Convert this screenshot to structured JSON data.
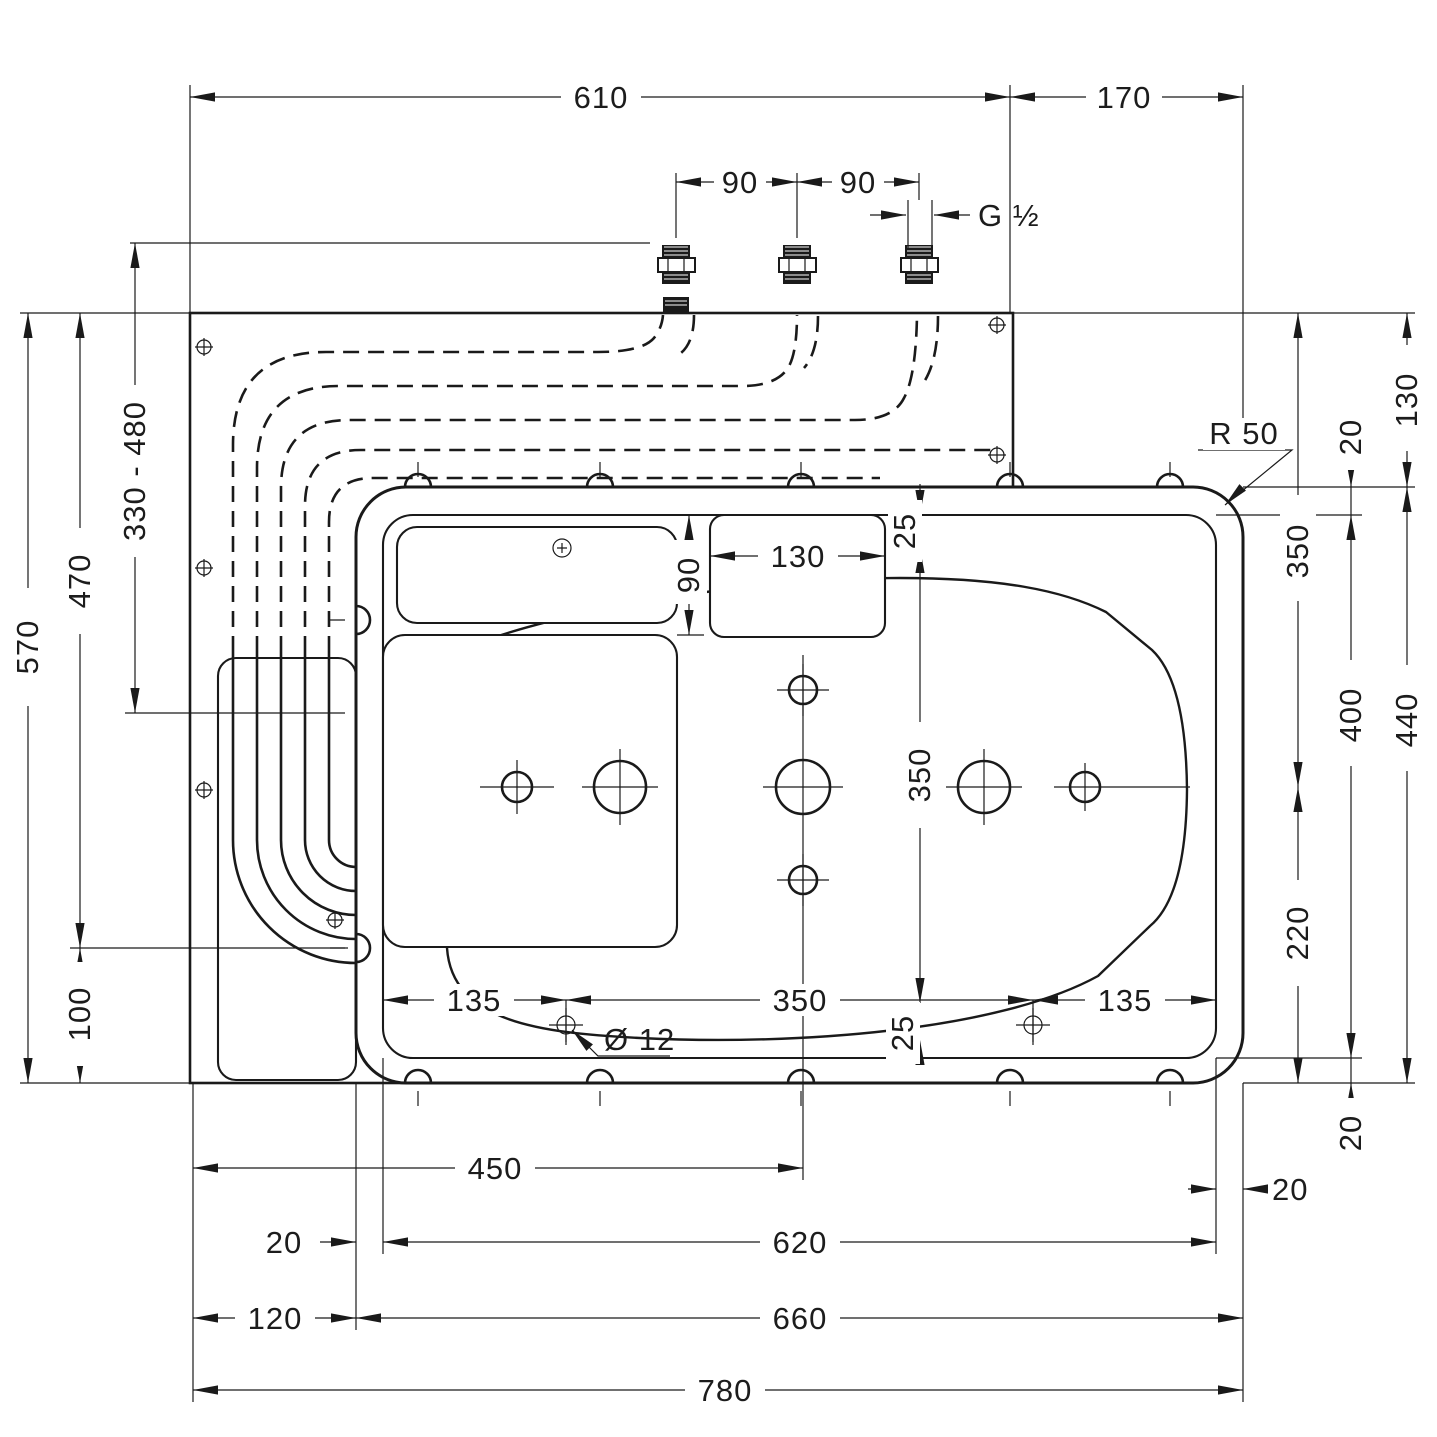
{
  "drawing": {
    "labels": {
      "t610": "610",
      "t170": "170",
      "t90a": "90",
      "t90b": "90",
      "thread": "G ½",
      "range": "330 - 480",
      "l470": "470",
      "l570": "570",
      "l100": "100",
      "r130": "130",
      "r20t": "20",
      "r50": "R 50",
      "r350": "350",
      "r400": "400",
      "r440": "440",
      "r220": "220",
      "r20b": "20",
      "c90": "90",
      "c130": "130",
      "c25t": "25",
      "c350": "350",
      "c25b": "25",
      "b135l": "135",
      "b350": "350",
      "b135r": "135",
      "dia12": "Ø 12",
      "b450": "450",
      "b20l": "20",
      "b620": "620",
      "b20r": "20",
      "b120": "120",
      "b660": "660",
      "b780": "780"
    }
  }
}
